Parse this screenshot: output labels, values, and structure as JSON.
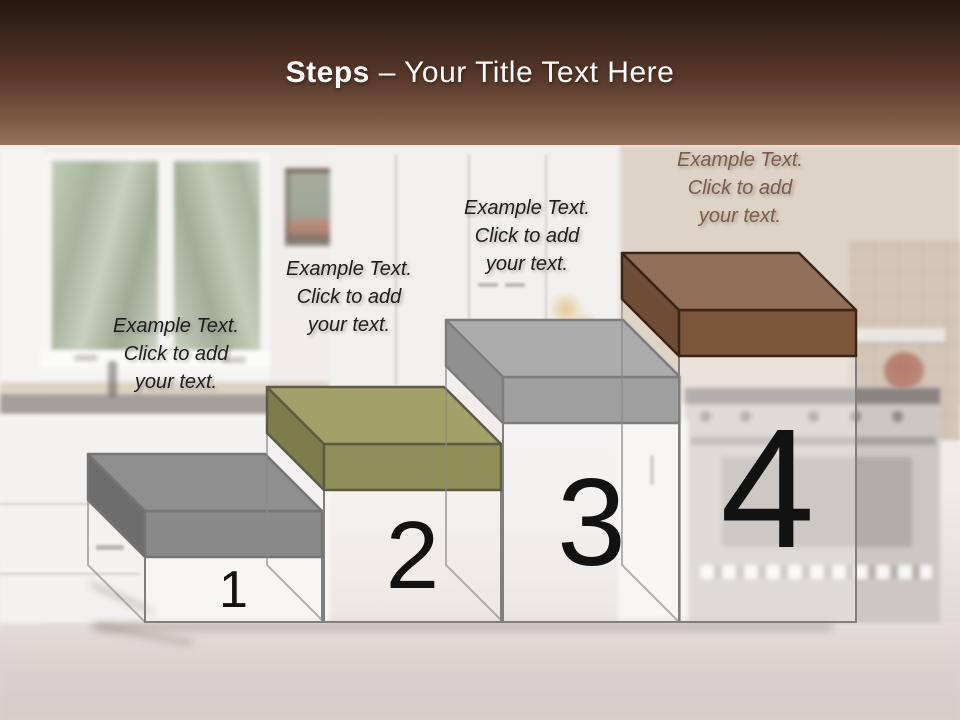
{
  "header": {
    "title_bold": "Steps",
    "title_rest": " – Your Title Text Here",
    "text_color": "#ffffff",
    "band_top_color": "#261710",
    "band_bottom_color": "#93735c"
  },
  "body_style": {
    "fill": "rgba(255,255,255,0.35)",
    "outline": "#7f7f7f"
  },
  "steps": [
    {
      "number": "1",
      "label_lines": [
        "Example Text.",
        "Click  to add",
        "your text."
      ],
      "label_color": "#1e1e1e",
      "cap_colors": {
        "top": "#8f8f8f",
        "front": "#898989",
        "left": "#6d6d6d",
        "outline": "#757575"
      }
    },
    {
      "number": "2",
      "label_lines": [
        "Example Text.",
        "Click  to add",
        "your text."
      ],
      "label_color": "#1e1e1e",
      "cap_colors": {
        "top": "#a2a268",
        "front": "#8f8f58",
        "left": "#7d7d4c",
        "outline": "#5c5c46"
      }
    },
    {
      "number": "3",
      "label_lines": [
        "Example Text.",
        "Click  to add",
        "your text."
      ],
      "label_color": "#1e1e1e",
      "cap_colors": {
        "top": "#acacac",
        "front": "#9f9f9f",
        "left": "#909090",
        "outline": "#7d7d7d"
      }
    },
    {
      "number": "4",
      "label_lines": [
        "Example Text.",
        "Click  to add",
        "your text."
      ],
      "label_color": "#7d5b48",
      "cap_colors": {
        "top": "#92715a",
        "front": "#7b563b",
        "left": "#6f4d34",
        "outline": "#3a2516"
      }
    }
  ]
}
